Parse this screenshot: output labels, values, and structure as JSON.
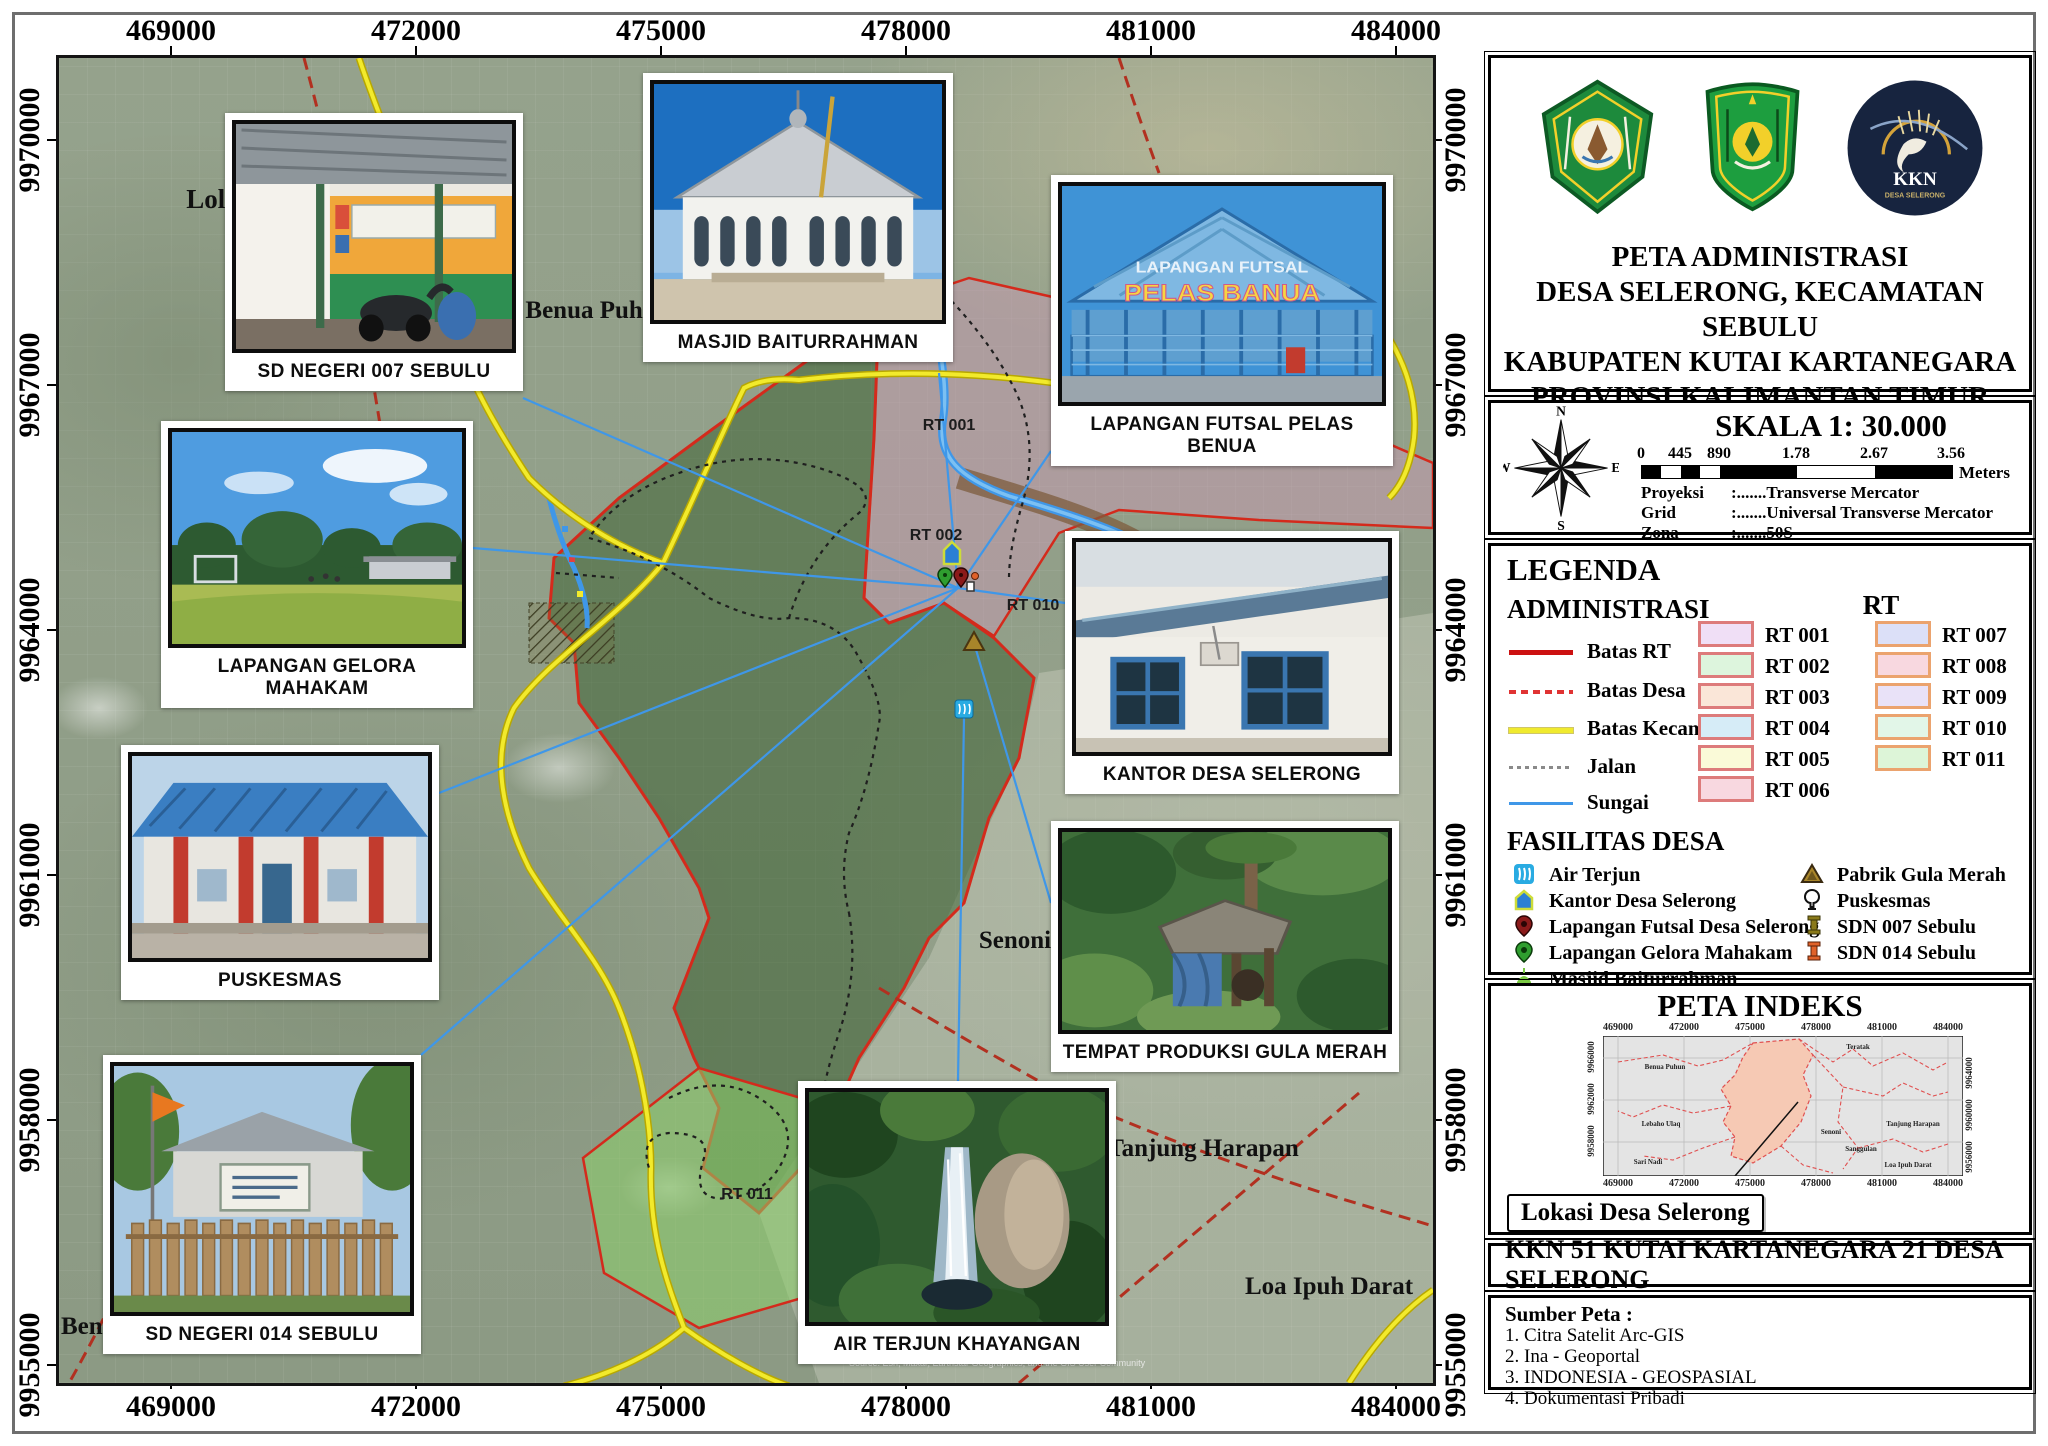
{
  "map": {
    "x_ticks": [
      "469000",
      "472000",
      "475000",
      "478000",
      "481000",
      "484000"
    ],
    "y_ticks": [
      "9970000",
      "9967000",
      "9964000",
      "9961000",
      "9958000",
      "9955000"
    ],
    "places": {
      "loleng": "Loleng",
      "benua_puhun": "Benua Puhun",
      "senoni": "Senoni",
      "tanjung_harapan": "Tanjung Harapan",
      "loa_ipuh_darat": "Loa Ipuh Darat",
      "ben": "Ben"
    },
    "rt_area_labels": {
      "rt001": "RT 001",
      "rt002": "RT 002",
      "rt010": "RT 010",
      "rt011": "RT 011"
    },
    "futsal_sign": {
      "line1": "LAPANGAN FUTSAL",
      "line2": "PELAS BANUA"
    },
    "attribution": "Source: Esri, Maxar, Earthstar Geographics, and the GIS User Community",
    "photos": [
      {
        "caption": "SD NEGERI 007 SEBULU"
      },
      {
        "caption": "MASJID BAITURRAHMAN"
      },
      {
        "caption": "LAPANGAN FUTSAL PELAS BENUA"
      },
      {
        "caption": "LAPANGAN GELORA MAHAKAM"
      },
      {
        "caption": "PUSKESMAS"
      },
      {
        "caption": "SD NEGERI 014 SEBULU"
      },
      {
        "caption": "KANTOR DESA SELERONG"
      },
      {
        "caption": "TEMPAT PRODUKSI GULA MERAH"
      },
      {
        "caption": "AIR TERJUN KHAYANGAN"
      }
    ],
    "colors": {
      "batas_rt": "#cc1111",
      "batas_desa": "#e03333",
      "batas_kecamatan": "#f0ea2e",
      "jalan": "#8a8a8a",
      "sungai": "#3f97e8"
    }
  },
  "sidebar": {
    "logos": {
      "univ": "Universitas Mulawarman",
      "kabupaten": "Kabupaten Kutai Kartanegara",
      "kkn_label": "KKN",
      "kkn_sub": "DESA SELERONG"
    },
    "title_lines": [
      "PETA ADMINISTRASI",
      "DESA SELERONG, KECAMATAN SEBULU",
      "KABUPATEN KUTAI KARTANEGARA",
      "PROVINSI KALIMANTAN TIMUR"
    ],
    "scale": {
      "heading": "SKALA 1: 30.000",
      "ticks": [
        "0",
        "445",
        "890",
        "1.78",
        "2.67",
        "3.56"
      ],
      "unit": "Meters",
      "rows": [
        {
          "label": "Proyeksi",
          "value": ":.......Transverse Mercator"
        },
        {
          "label": "Grid",
          "value": ":.......Universal Transverse Mercator"
        },
        {
          "label": "Zona",
          "value": ":.......50S"
        },
        {
          "label": "WGS",
          "value": ":.......WGS 1984"
        }
      ],
      "compass": {
        "n": "N",
        "e": "E",
        "s": "S",
        "w": "W"
      }
    },
    "legend": {
      "heading": "LEGENDA",
      "administrasi": "ADMINISTRASI",
      "rt_heading": "RT",
      "admin_items": [
        "Batas RT",
        "Batas Desa",
        "Batas Kecamatan",
        "Jalan",
        "Sungai"
      ],
      "rt_items": [
        {
          "label": "RT 001",
          "fill": "#f0dff6"
        },
        {
          "label": "RT 002",
          "fill": "#ddf5dd"
        },
        {
          "label": "RT 003",
          "fill": "#fae6d8"
        },
        {
          "label": "RT 004",
          "fill": "#d6ecf7"
        },
        {
          "label": "RT 005",
          "fill": "#fafad8"
        },
        {
          "label": "RT 006",
          "fill": "#f8d8e0"
        },
        {
          "label": "RT 007",
          "fill": "#dce0f8"
        },
        {
          "label": "RT 008",
          "fill": "#f8d8e0"
        },
        {
          "label": "RT 009",
          "fill": "#e9e2f8"
        },
        {
          "label": "RT 010",
          "fill": "#e2f6e8"
        },
        {
          "label": "RT 011",
          "fill": "#ddf5d8"
        }
      ],
      "fasilitas_heading": "FASILITAS DESA",
      "fasilitas_left": [
        "Air Terjun",
        "Kantor Desa Selerong",
        "Lapangan Futsal Desa Selerong",
        "Lapangan Gelora Mahakam",
        "Masjid Baiturrahman"
      ],
      "fasilitas_right": [
        "Pabrik Gula Merah",
        "Puskesmas",
        "SDN 007 Sebulu",
        "SDN 014 Sebulu"
      ]
    },
    "indeks": {
      "heading": "PETA INDEKS",
      "x_ticks": [
        "469000",
        "472000",
        "475000",
        "478000",
        "481000",
        "484000"
      ],
      "y_left": [
        "9966000",
        "9962000",
        "9958000"
      ],
      "y_right": [
        "9964000",
        "9960000",
        "9956000"
      ],
      "places": [
        "Teratak",
        "Benua Puhun",
        "Lebaho Ulaq",
        "Senoni",
        "Sanggulan",
        "Sari Nadi",
        "Tanjung Harapan",
        "Loa Ipuh Darat"
      ],
      "callout": "Lokasi Desa Selerong"
    },
    "kkn_bar": "KKN 51 KUTAI KARTANEGARA 21 DESA SELERONG",
    "sumber": {
      "heading": "Sumber Peta :",
      "items": [
        "1. Citra Satelit Arc-GIS",
        "2. Ina - Geoportal",
        "3. INDONESIA - GEOSPASIAL",
        "4. Dokumentasi Pribadi"
      ]
    }
  }
}
